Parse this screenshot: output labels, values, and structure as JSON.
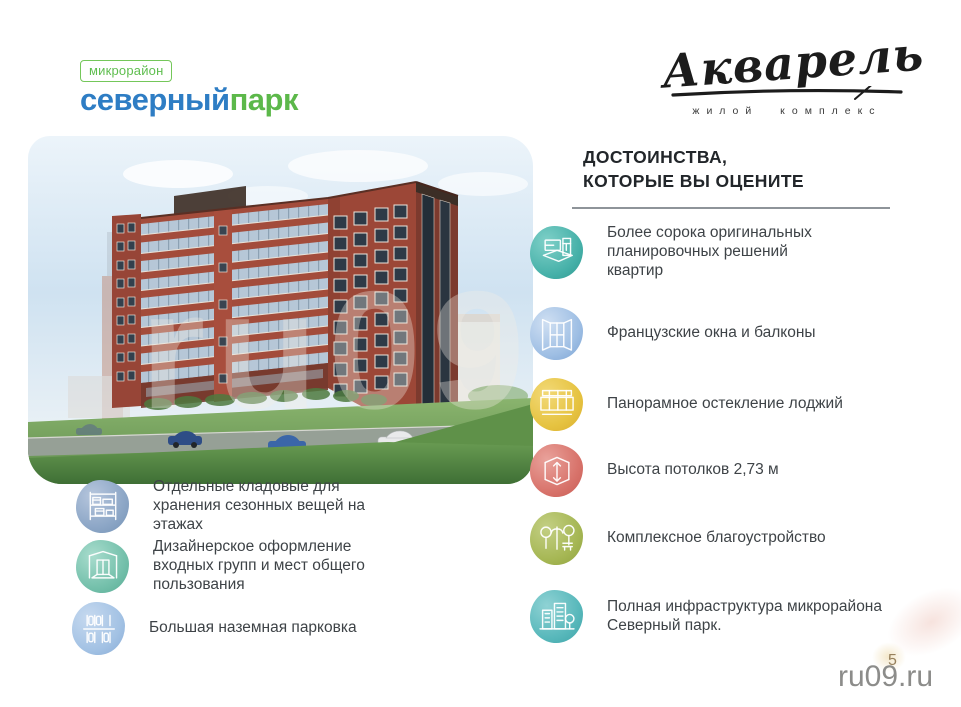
{
  "page": {
    "page_number": "5",
    "watermark": "ru09.ru",
    "background": "#ffffff"
  },
  "brand": {
    "district_badge": "микрорайон",
    "district_name_part1": "северный",
    "district_name_part2": "парк",
    "district_color_blue": "#2e7dc4",
    "district_color_green": "#5cb84a",
    "badge_color_green": "#5fbe4f",
    "complex_name": "Акварель",
    "complex_subtitle": "жилой комплекс"
  },
  "heading": {
    "line1": "ДОСТОИНСТВА,",
    "line2": "КОТОРЫЕ ВЫ ОЦЕНИТЕ"
  },
  "artwork": {
    "watermark": "ru09"
  },
  "right_features": [
    {
      "icon": "floorplan-icon",
      "color": "#45b0a8",
      "text": "Более сорока оригинальных планировочных решений квартир"
    },
    {
      "icon": "french-window-icon",
      "color": "#9fbfe4",
      "text": "Французские окна и балконы"
    },
    {
      "icon": "panoramic-glazing-icon",
      "color": "#e6c341",
      "text": "Панорамное остекление лоджий"
    },
    {
      "icon": "ceiling-height-icon",
      "color": "#d8736b",
      "text": "Высота потолков 2,73 м"
    },
    {
      "icon": "landscaping-icon",
      "color": "#a6b754",
      "text": "Комплексное благоустройство"
    },
    {
      "icon": "infrastructure-icon",
      "color": "#58b8bb",
      "text": "Полная инфраструктура микрорайона Северный парк."
    }
  ],
  "left_features": [
    {
      "icon": "storage-icon",
      "color": "#8ca6c6",
      "text": "Отдельные кладовые для хранения сезонных вещей на этажах"
    },
    {
      "icon": "entrance-icon",
      "color": "#74c0ab",
      "text": "Дизайнерское оформление входных групп и мест общего пользования"
    },
    {
      "icon": "parking-icon",
      "color": "#a3c2e4",
      "text": "Большая наземная парковка"
    }
  ]
}
